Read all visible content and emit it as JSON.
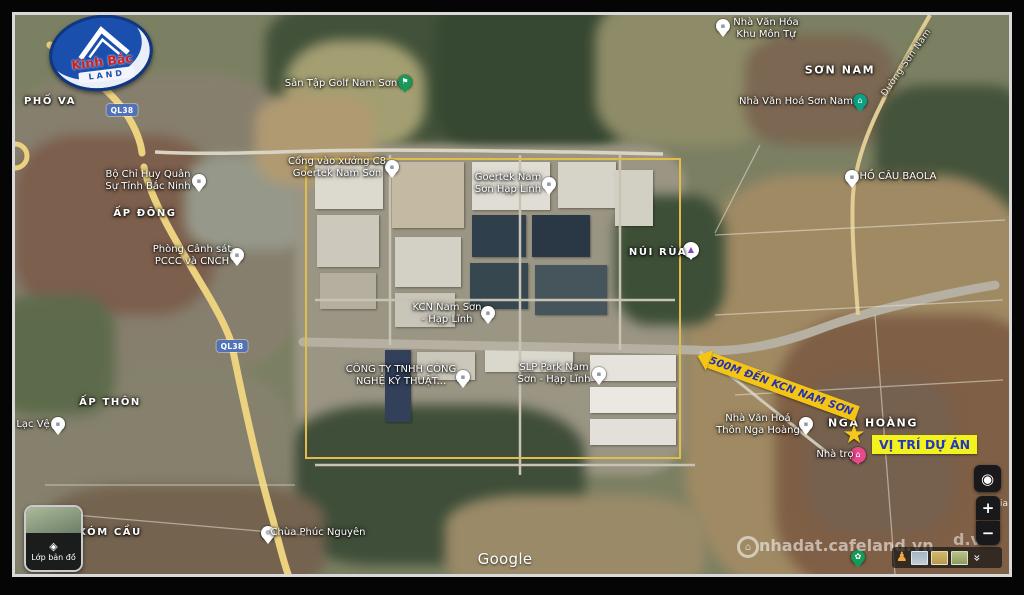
{
  "logo": {
    "name": "Kinh Bắc",
    "land": "LAND"
  },
  "places": {
    "pho_va": "PHỐ VA",
    "son_nam": "SƠN NAM",
    "ap_dong": "ẤP ĐÔNG",
    "ap_thon": "ẤP THÔN",
    "xom_cau": "XÓM CẦU",
    "nga_hoang": "NGA HOÀNG"
  },
  "roads": {
    "badge1": "QL38",
    "badge2": "QL38",
    "duong_son_nam": "Đường Sơn Nam"
  },
  "pois": [
    {
      "name": "bo-chi-huy-quan-su",
      "icon": "building-icon",
      "glyph": "▪",
      "lines": [
        "Bộ Chỉ Huy Quân",
        "Sự Tỉnh Bắc Ninh"
      ]
    },
    {
      "name": "san-tap-golf-nam-son",
      "icon": "golf-flag-icon",
      "glyph": "⚑",
      "lines": [
        "Sân Tập Golf Nam Sơn"
      ]
    },
    {
      "name": "nha-van-hoa-khu-mon-tu",
      "icon": "building-icon",
      "glyph": "▪",
      "lines": [
        "Nhà Văn Hóa",
        "Khu Môn Tự"
      ]
    },
    {
      "name": "nha-van-hoa-son-nam",
      "icon": "community-house-icon",
      "glyph": "⌂",
      "lines": [
        "Nhà Văn Hoá Sơn Nam"
      ]
    },
    {
      "name": "ho-cau-baola",
      "icon": "fishing-lake-icon",
      "glyph": "▪",
      "lines": [
        "HỒ CÂU BAOLA"
      ]
    },
    {
      "name": "phong-canh-sat-pccc",
      "icon": "fire-station-icon",
      "glyph": "▪",
      "lines": [
        "Phòng Cảnh sát",
        "PCCC và CNCH"
      ]
    },
    {
      "name": "cong-vao-xuong-c8",
      "icon": "factory-gate-icon",
      "glyph": "▪",
      "lines": [
        "Cổng vào xưởng C8",
        "Goertek Nam Sơn"
      ]
    },
    {
      "name": "goertek-nam-son-hap-linh",
      "icon": "factory-icon",
      "glyph": "▪",
      "lines": [
        "Goertek Nam",
        "Sơn Hạp Lĩnh"
      ]
    },
    {
      "name": "nui-rua",
      "icon": "mountain-icon",
      "glyph": "▲",
      "lines": [
        "NÚI RÙA"
      ]
    },
    {
      "name": "kcn-nam-son-hap-linh",
      "icon": "industrial-zone-icon",
      "glyph": "▪",
      "lines": [
        "KCN Nam Sơn",
        "- Hạp Lĩnh"
      ]
    },
    {
      "name": "cong-ty-tnhh-cong-nghe",
      "icon": "company-icon",
      "glyph": "▪",
      "lines": [
        "CÔNG TY TNHH CÔNG",
        "NGHỆ KỸ THUẬT..."
      ]
    },
    {
      "name": "slp-park-nam-son",
      "icon": "warehouse-icon",
      "glyph": "▪",
      "lines": [
        "SLP Park Nam",
        "Sơn - Hạp Lĩnh"
      ]
    },
    {
      "name": "nha-van-hoa-thon-nga-hoang",
      "icon": "community-house-icon",
      "glyph": "▪",
      "lines": [
        "Nhà Văn Hoá",
        "Thôn Nga Hoàng"
      ]
    },
    {
      "name": "nha-tro",
      "icon": "guesthouse-icon",
      "glyph": "⌂",
      "lines": [
        "Nhà trọ"
      ]
    },
    {
      "name": "lac-ve",
      "icon": "place-icon",
      "glyph": "▪",
      "lines": [
        "Lạc Vệ"
      ]
    },
    {
      "name": "chua-phuc-nguyen",
      "icon": "pagoda-wheel-icon",
      "glyph": "☸",
      "lines": [
        "Chùa Phúc Nguyên"
      ]
    },
    {
      "name": "garden-spot",
      "icon": "flower-icon",
      "glyph": "✿",
      "lines": []
    }
  ],
  "annotations": {
    "arrow_label": "500M ĐẾN KCN NAM SƠN",
    "site_label": "VỊ TRÍ DỰ ÁN",
    "star_icon": "★",
    "boundary_color": "#e3bd49",
    "arrow_color": "#f5c514",
    "highlight_color": "#f4f21c",
    "label_blue": "#2336c0"
  },
  "attribution": {
    "google": "Google",
    "watermark": "nhadat.cafeland.vn",
    "watermark_fragment_right": "d.vn",
    "watermark_fragment_small": "ia"
  },
  "controls": {
    "layers_label": "Lớp bản đồ",
    "layers_icon": "◈",
    "zoom_in": "+",
    "zoom_out": "−",
    "my_location_icon": "◉",
    "collapse_icon": "«",
    "pegman_icon": "♟"
  }
}
